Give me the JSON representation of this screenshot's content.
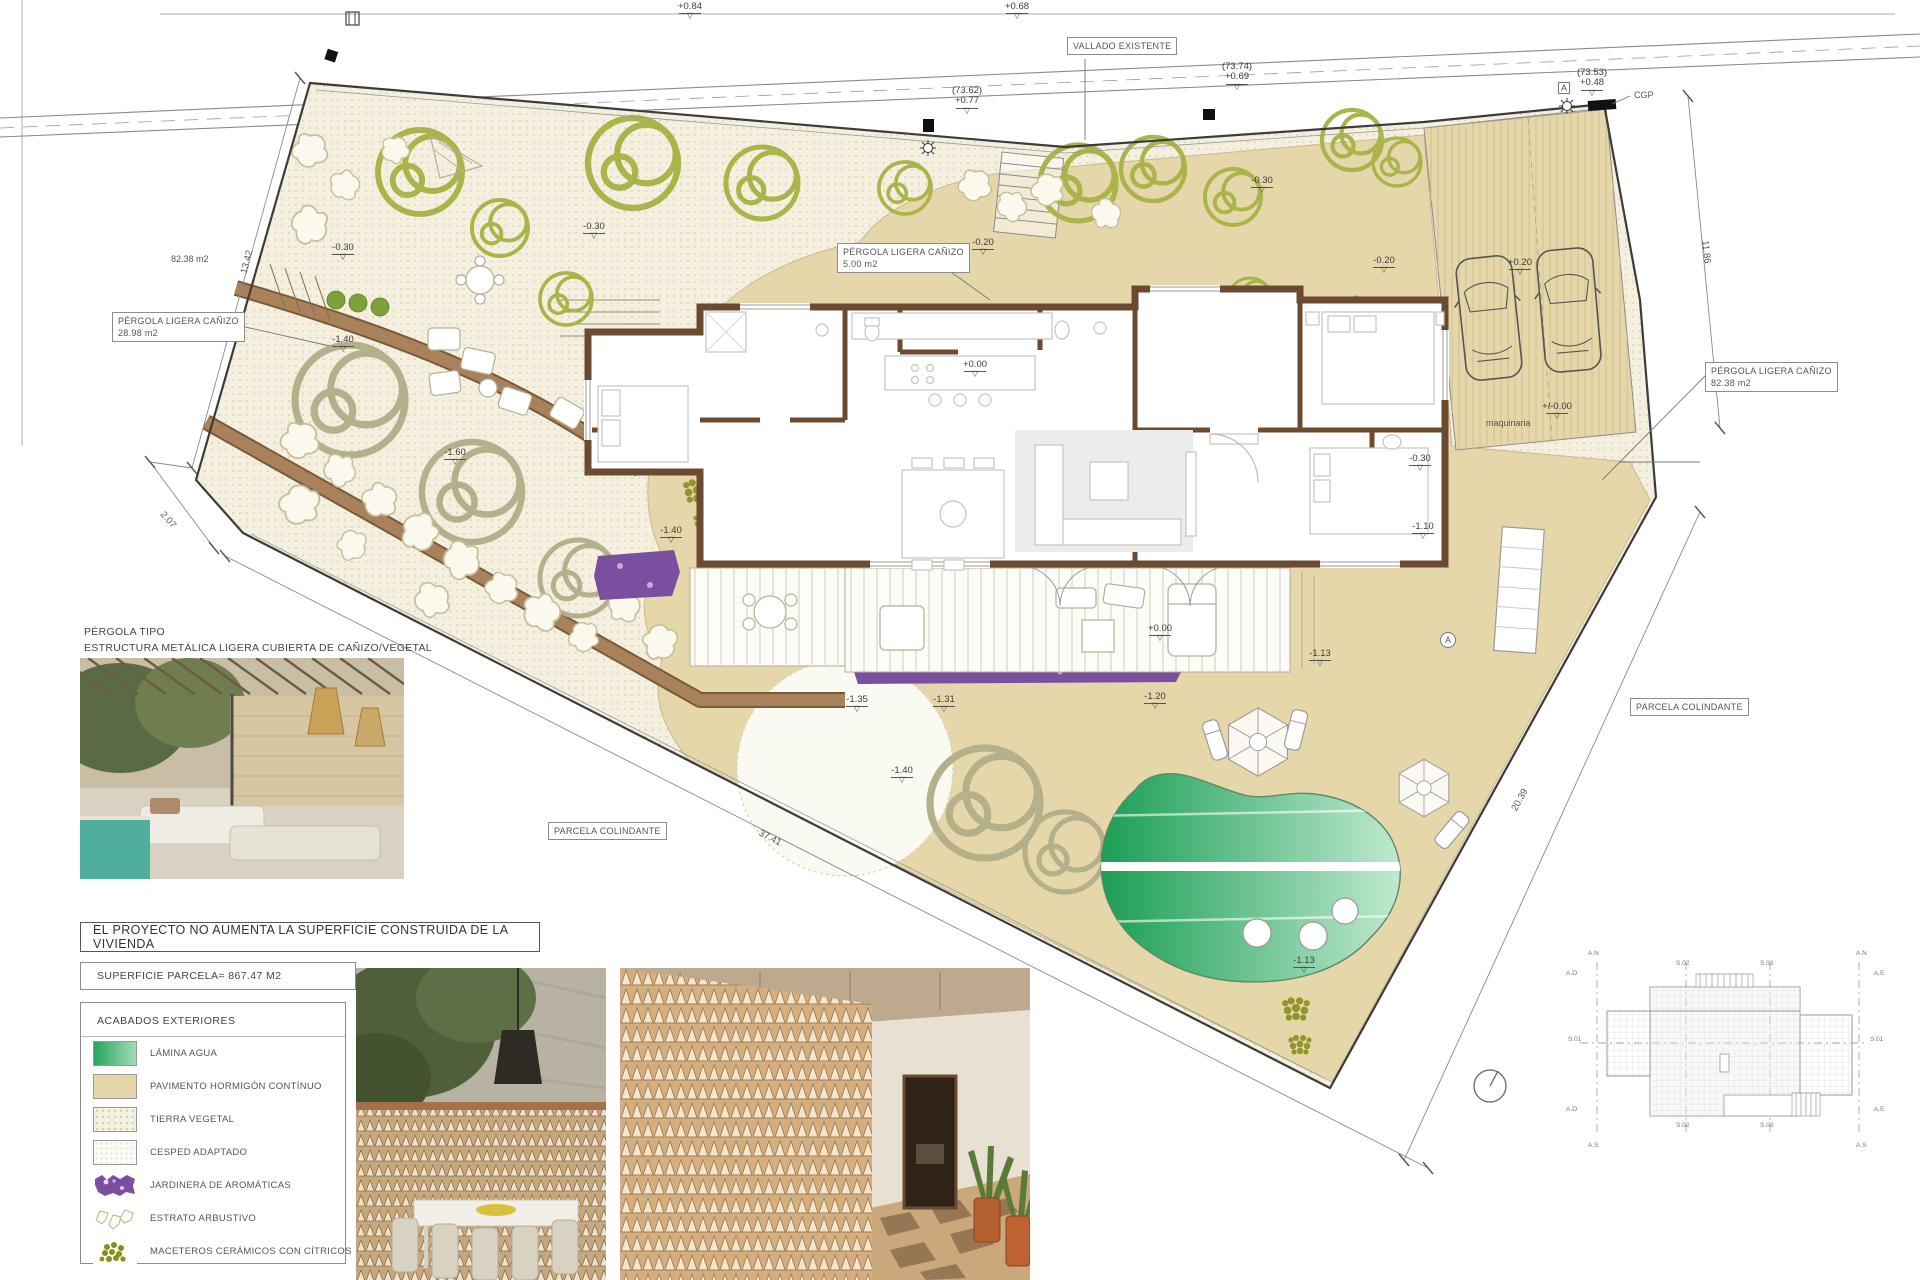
{
  "colors": {
    "pavement": "#e6d7ab",
    "tierra": "#f4efde",
    "wall": "#6b4a31",
    "path_brown": "#a9825c",
    "pool_dark": "#1b9e55",
    "pool_light": "#bfe9cf",
    "jardinera": "#7b4fa0",
    "tree": "#a9b54a",
    "tree_dark": "#7da23c",
    "citrus": "#8a8d1f",
    "roof": "#eaeae6",
    "line": "#4a4a4a"
  },
  "notes": {
    "project": "EL PROYECTO NO AUMENTA LA SUPERFICIE CONSTRUIDA DE LA VIVIENDA",
    "superficie": "SUPERFICIE PARCELA= 867.47 M2"
  },
  "pergola_caption": {
    "line1": "PÉRGOLA TIPO",
    "line2": "ESTRUCTURA METÁLICA LIGERA CUBIERTA DE CAÑIZO/VEGETAL"
  },
  "legend": {
    "title": "ACABADOS  EXTERIORES",
    "items": [
      {
        "type": "agua",
        "label": "LÁMINA AGUA"
      },
      {
        "type": "pavimento",
        "label": "PAVIMENTO HORMIGÓN CONTÍNUO"
      },
      {
        "type": "tierra",
        "label": "TIERRA VEGETAL"
      },
      {
        "type": "cesped",
        "label": "CESPED ADAPTADO"
      },
      {
        "type": "jardinera",
        "label": "JARDINERA  DE AROMÁTICAS"
      },
      {
        "type": "arbustivo",
        "label": "ESTRATO ARBUSTIVO"
      },
      {
        "type": "citricos",
        "label": "MACETEROS CERÁMICOS CON CÍTRICOS"
      }
    ]
  },
  "labels": [
    {
      "lines": [
        "VALLADO EXISTENTE"
      ],
      "x": 1067,
      "y": 37
    },
    {
      "lines": [
        "PÉRGOLA LIGERA CAÑIZO",
        "28.98 m2"
      ],
      "x": 112,
      "y": 312
    },
    {
      "lines": [
        "PÉRGOLA LIGERA CAÑIZO",
        "5.00 m2"
      ],
      "x": 837,
      "y": 243
    },
    {
      "lines": [
        "PÉRGOLA LIGERA CAÑIZO",
        "82.38 m2"
      ],
      "x": 1705,
      "y": 362
    },
    {
      "lines": [
        "PARCELA COLINDANTE"
      ],
      "x": 548,
      "y": 822
    },
    {
      "lines": [
        "PARCELA COLINDANTE"
      ],
      "x": 1630,
      "y": 698
    }
  ],
  "levels": [
    {
      "t": "+0.84",
      "x": 690,
      "y": 2
    },
    {
      "t": "+0.68",
      "x": 1017,
      "y": 2
    },
    {
      "pre": "(73.62)",
      "t": "+0.77",
      "x": 967,
      "y": 86
    },
    {
      "pre": "(73.74)",
      "t": "+0.69",
      "x": 1237,
      "y": 62
    },
    {
      "pre": "(73.53)",
      "t": "+0.48",
      "x": 1592,
      "y": 68
    },
    {
      "t": "-0.30",
      "x": 1262,
      "y": 176
    },
    {
      "t": "-0.30",
      "x": 594,
      "y": 222
    },
    {
      "t": "-0.30",
      "x": 343,
      "y": 243
    },
    {
      "t": "-1.40",
      "x": 343,
      "y": 335
    },
    {
      "t": "-0.20",
      "x": 983,
      "y": 238
    },
    {
      "t": "-0.20",
      "x": 1384,
      "y": 256
    },
    {
      "t": "+0.20",
      "x": 1520,
      "y": 258
    },
    {
      "t": "+/-0.00",
      "x": 1557,
      "y": 402
    },
    {
      "t": "-0.30",
      "x": 1420,
      "y": 454
    },
    {
      "t": "-1.10",
      "x": 1423,
      "y": 522
    },
    {
      "t": "-1.40",
      "x": 671,
      "y": 526
    },
    {
      "t": "-1.60",
      "x": 455,
      "y": 448
    },
    {
      "t": "+0.00",
      "x": 975,
      "y": 360
    },
    {
      "t": "+0.00",
      "x": 1160,
      "y": 624
    },
    {
      "t": "-1.13",
      "x": 1320,
      "y": 649
    },
    {
      "t": "-1.35",
      "x": 857,
      "y": 695
    },
    {
      "t": "-1.31",
      "x": 944,
      "y": 695
    },
    {
      "t": "-1.20",
      "x": 1155,
      "y": 692
    },
    {
      "t": "-1.40",
      "x": 902,
      "y": 766
    },
    {
      "t": "-1.13",
      "x": 1304,
      "y": 956
    }
  ],
  "dims": [
    {
      "t": "13.42",
      "x": 247,
      "y": 262,
      "rot": -75
    },
    {
      "t": "2.07",
      "x": 168,
      "y": 520,
      "rot": 49
    },
    {
      "t": "37.41",
      "x": 770,
      "y": 838,
      "rot": 27
    },
    {
      "t": "20.39",
      "x": 1520,
      "y": 800,
      "rot": -61
    },
    {
      "t": "11.86",
      "x": 1706,
      "y": 252,
      "rot": 84
    }
  ],
  "texts": [
    {
      "t": "82.38 m2",
      "x": 171,
      "y": 254
    },
    {
      "t": "CGP",
      "x": 1634,
      "y": 90
    },
    {
      "t": "maquinaria",
      "x": 1486,
      "y": 418
    },
    {
      "t": "A",
      "x": 1558,
      "y": 82,
      "style": "box"
    },
    {
      "t": "A",
      "x": 1440,
      "y": 632,
      "style": "circ"
    }
  ],
  "roof": {
    "markers": [
      {
        "t": "A.N",
        "x": 1588,
        "y": 950
      },
      {
        "t": "A.N",
        "x": 1856,
        "y": 950
      },
      {
        "t": "A.S",
        "x": 1588,
        "y": 1142
      },
      {
        "t": "A.S",
        "x": 1856,
        "y": 1142
      },
      {
        "t": "A.O",
        "x": 1566,
        "y": 970
      },
      {
        "t": "A.E",
        "x": 1874,
        "y": 970
      },
      {
        "t": "A.O",
        "x": 1566,
        "y": 1106
      },
      {
        "t": "A.E",
        "x": 1874,
        "y": 1106
      },
      {
        "t": "S.01",
        "x": 1568,
        "y": 1036
      },
      {
        "t": "S.01",
        "x": 1870,
        "y": 1036
      },
      {
        "t": "S.02",
        "x": 1676,
        "y": 960
      },
      {
        "t": "S.02",
        "x": 1676,
        "y": 1122
      },
      {
        "t": "S.03",
        "x": 1760,
        "y": 960
      },
      {
        "t": "S.03",
        "x": 1760,
        "y": 1122
      }
    ]
  }
}
